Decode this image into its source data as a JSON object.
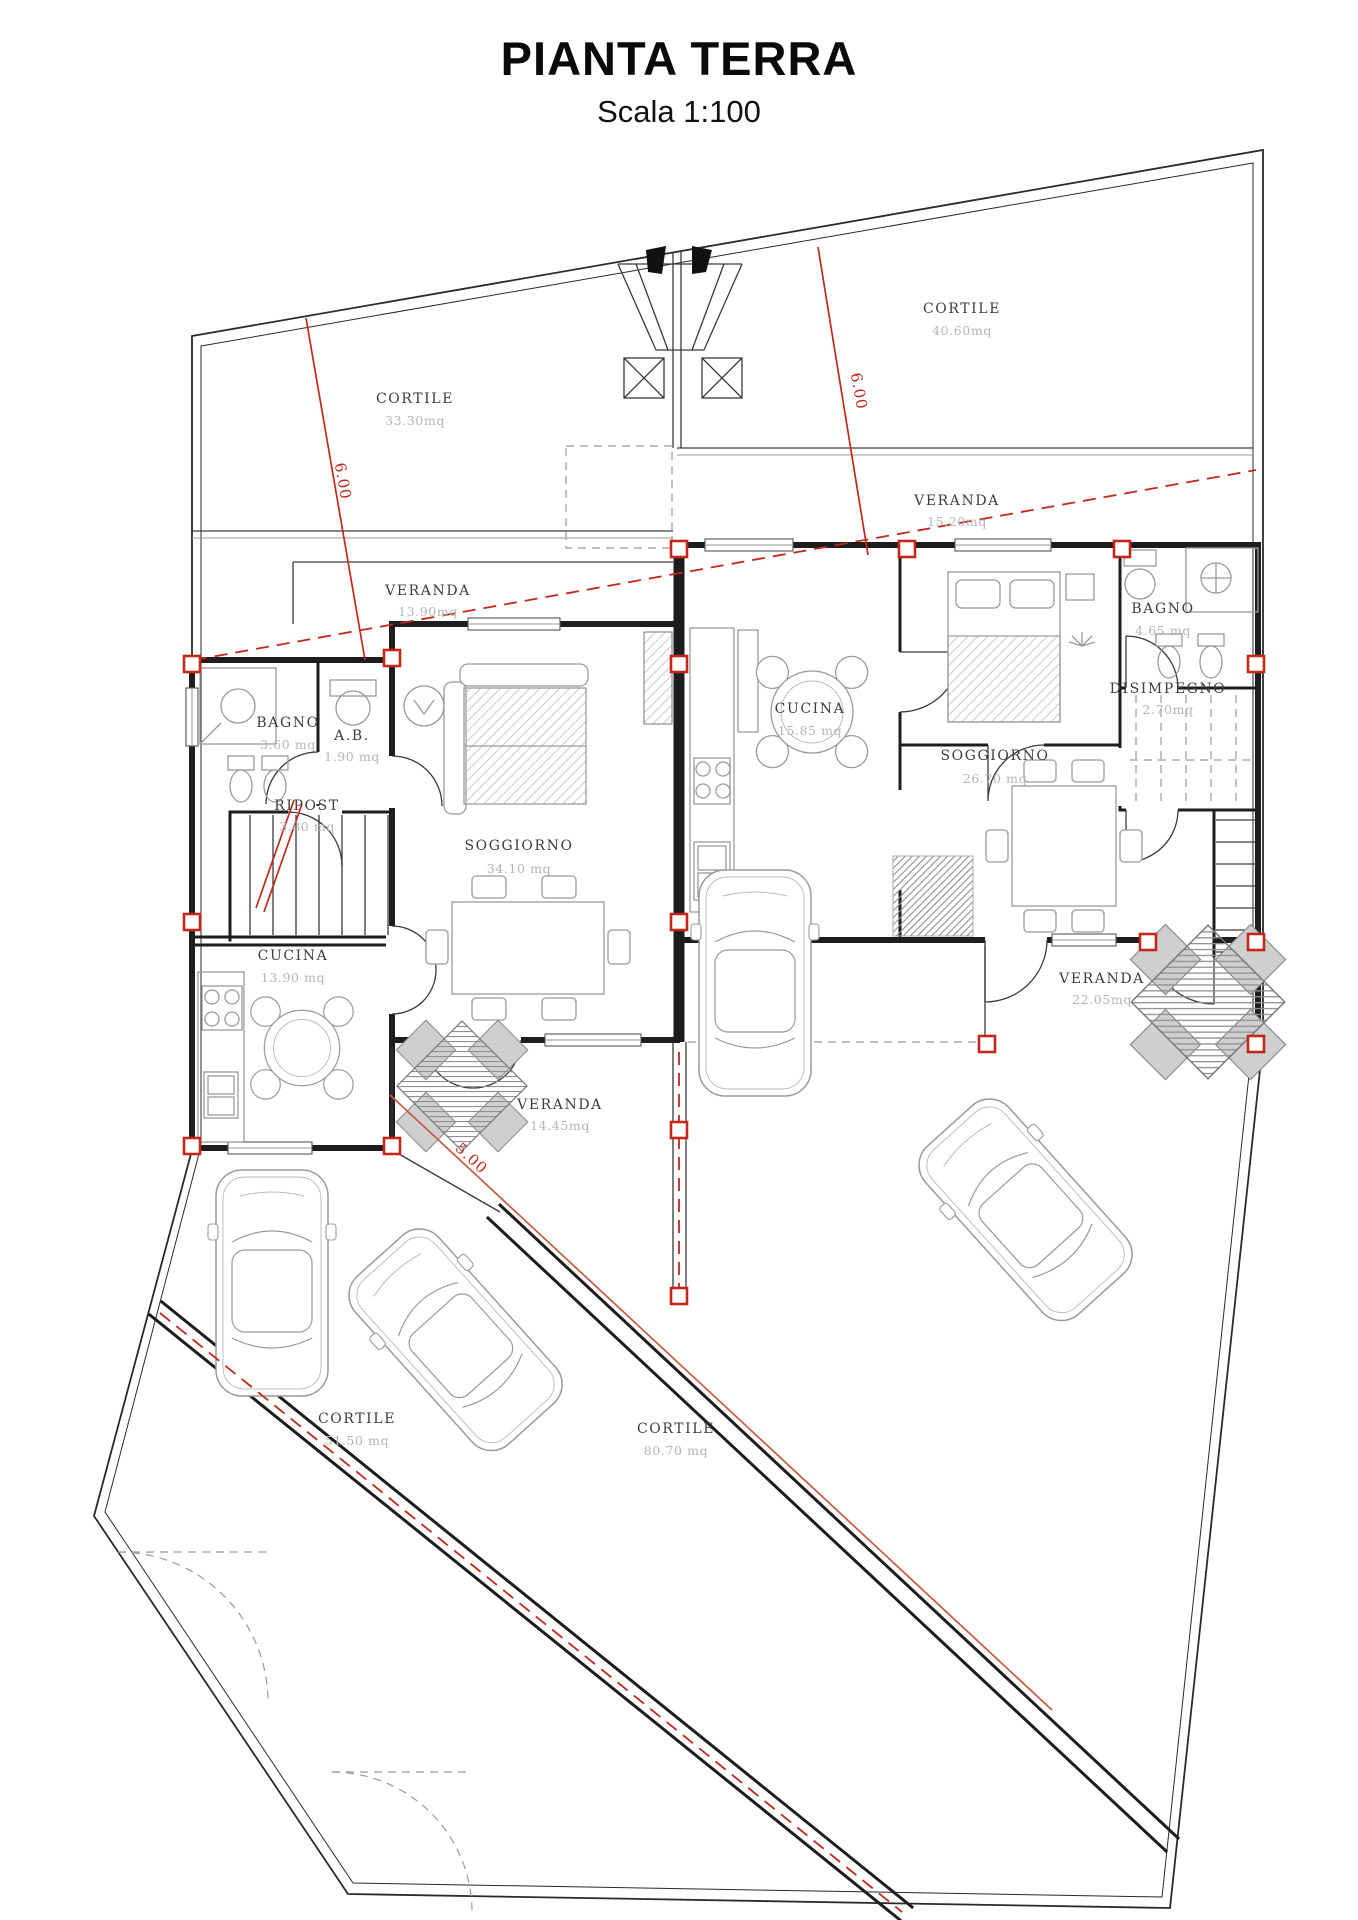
{
  "title": {
    "main": "PIANTA TERRA",
    "scale": "Scala 1:100"
  },
  "colors": {
    "wall": "#1d1d1d",
    "boundary": "#2a2a2a",
    "furniture": "#9a9a9a",
    "red_accent": "#c3271b",
    "dimension_line": "#c85a3f",
    "room_text": "#3d3d3d",
    "area_text": "#b5b5b5"
  },
  "rooms": [
    {
      "id": "cortile-top-left",
      "name": "CORTILE",
      "area": "33.30mq"
    },
    {
      "id": "cortile-top-right",
      "name": "CORTILE",
      "area": "40.60mq"
    },
    {
      "id": "veranda-top-right",
      "name": "VERANDA",
      "area": "15.20mq"
    },
    {
      "id": "veranda-left",
      "name": "VERANDA",
      "area": "13.90mq"
    },
    {
      "id": "bagno-left",
      "name": "BAGNO",
      "area": "3.60 mq"
    },
    {
      "id": "ab-left",
      "name": "A.B.",
      "area": "1.90 mq"
    },
    {
      "id": "ripost",
      "name": "RIPOST",
      "area": "3.80 mq"
    },
    {
      "id": "soggiorno-left",
      "name": "SOGGIORNO",
      "area": "34.10 mq"
    },
    {
      "id": "cucina-left",
      "name": "CUCINA",
      "area": "13.90 mq"
    },
    {
      "id": "veranda-left-bottom",
      "name": "VERANDA",
      "area": "14.45mq"
    },
    {
      "id": "cucina-right",
      "name": "CUCINA",
      "area": "15.85 mq"
    },
    {
      "id": "soggiorno-right",
      "name": "SOGGIORNO",
      "area": "26.70 mq"
    },
    {
      "id": "bagno-right",
      "name": "BAGNO",
      "area": "4.65 mq"
    },
    {
      "id": "disimpegno",
      "name": "DISIMPEGNO",
      "area": "2.70mq"
    },
    {
      "id": "veranda-right-bottom",
      "name": "VERANDA",
      "area": "22.05mq"
    },
    {
      "id": "cortile-bottom-left",
      "name": "CORTILE",
      "area": "51.50 mq"
    },
    {
      "id": "cortile-bottom-center",
      "name": "CORTILE",
      "area": "80.70 mq"
    }
  ],
  "dimensions": [
    {
      "label": "6.00",
      "position": "left-setback"
    },
    {
      "label": "6.00",
      "position": "right-setback"
    },
    {
      "label": "5.00",
      "position": "driveway"
    }
  ]
}
